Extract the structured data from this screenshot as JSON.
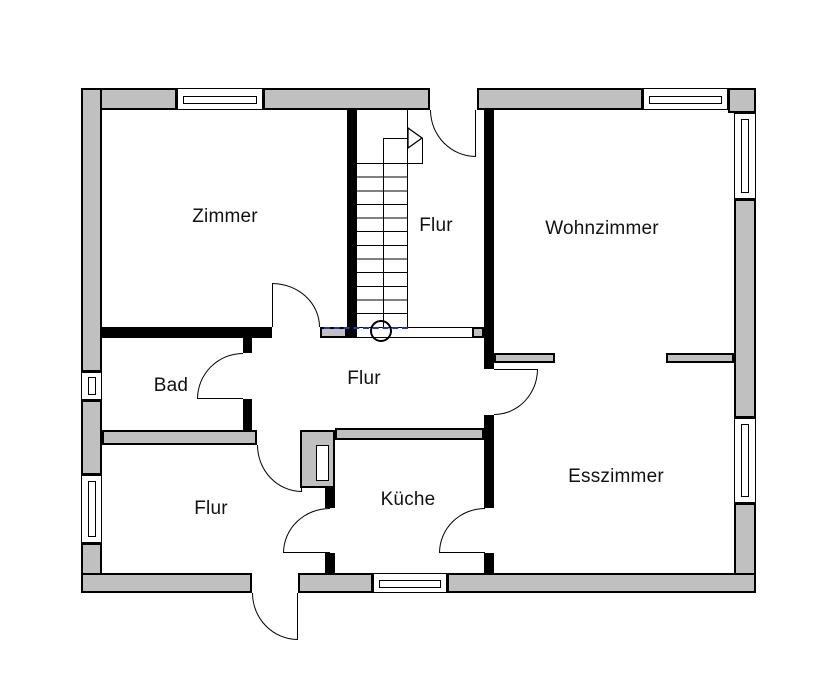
{
  "plan": {
    "type": "floorplan",
    "rooms": {
      "zimmer": {
        "label": "Zimmer"
      },
      "flur_top": {
        "label": "Flur"
      },
      "wohnzimmer": {
        "label": "Wohnzimmer"
      },
      "bad": {
        "label": "Bad"
      },
      "flur_mitte": {
        "label": "Flur"
      },
      "esszimmer": {
        "label": "Esszimmer"
      },
      "flur_unten": {
        "label": "Flur"
      },
      "kueche": {
        "label": "Küche"
      }
    },
    "colors": {
      "wall_fill": "#c0c0c0",
      "line": "#000000",
      "section_marker": "#2233cc",
      "background": "#ffffff"
    },
    "features": [
      "stairs-up",
      "chimney-shaft",
      "section-marker-circle"
    ]
  }
}
